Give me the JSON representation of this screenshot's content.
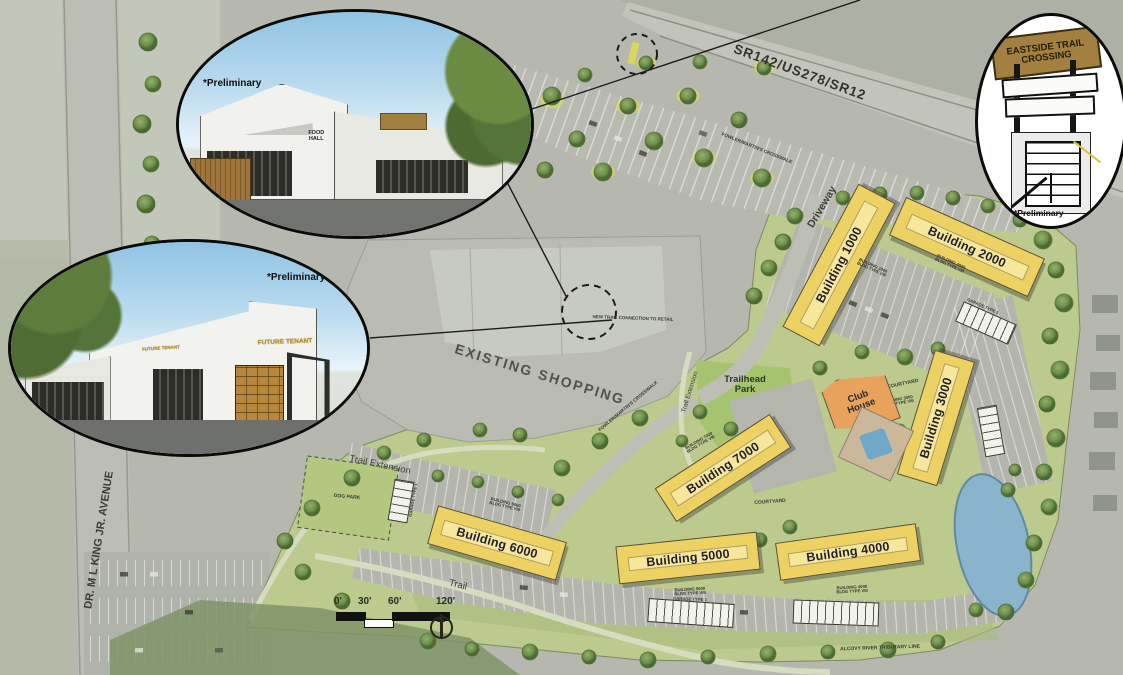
{
  "roads": {
    "highway": "SR142/US278/SR12",
    "avenue": "DR. M L KING JR. AVENUE",
    "driveway": "Driveway"
  },
  "areas": {
    "existing_shopping": "EXISTING SHOPPING",
    "trailhead_park": "Trailhead\nPark",
    "trail_extension": "Trail Extension",
    "trail_extension_vertical": "Trail Extension",
    "trail": "Trail",
    "dog_park": "DOG PARK",
    "courtyard": "COURTYARD",
    "pool_courtyard": "POOL COURTYARD",
    "alcovy_note": "ALCOVY RIVER TRIBUTARY LINE"
  },
  "club_house": {
    "label": "Club\nHouse"
  },
  "buildings": [
    {
      "label": "Building 1000",
      "sub": "BUILDING 1000\nBLDG TYPE VIII"
    },
    {
      "label": "Building 2000",
      "sub": "BUILDING 2000\nBLDG TYPE VIII"
    },
    {
      "label": "Building 3000",
      "sub": "BUILDING 3000\nBLDG TYPE VIII"
    },
    {
      "label": "Building 4000",
      "sub": "BUILDING 4000\nBLDG TYPE VIII"
    },
    {
      "label": "Building 5000",
      "sub": "BUILDING 5000\nBLDG TYPE VIII"
    },
    {
      "label": "Building 6000",
      "sub": "BUILDING 6000\nBLDG TYPE VIII"
    },
    {
      "label": "Building 7000",
      "sub": "BUILDING 7000\nBLDG TYPE VIII"
    }
  ],
  "annotations": {
    "crosswalk": "FOWLER/MARTIN'S CROSSWALK",
    "new_trail_connection": "NEW TRAIL CONNECTION TO RETAIL",
    "garage": "GARAGE TYPE 1"
  },
  "scalebar": {
    "t0": "0'",
    "t1": "30'",
    "t2": "60'",
    "t3": "120'"
  },
  "insets": {
    "preliminary": "*Preliminary",
    "retail_top": {
      "sign": "FOOD\nHALL"
    },
    "retail_bottom": {
      "sign_left": "FUTURE TENANT",
      "sign_right": "FUTURE TENANT"
    },
    "trail_crossing": {
      "sign": "EASTSIDE TRAIL\nCROSSING"
    }
  },
  "colors": {
    "building_fill": "#eed163",
    "clubhouse_fill": "#e8a25c",
    "water": "#8ab4cc",
    "site_green": "#bcca8e",
    "sign_wood": "#a3803f"
  }
}
